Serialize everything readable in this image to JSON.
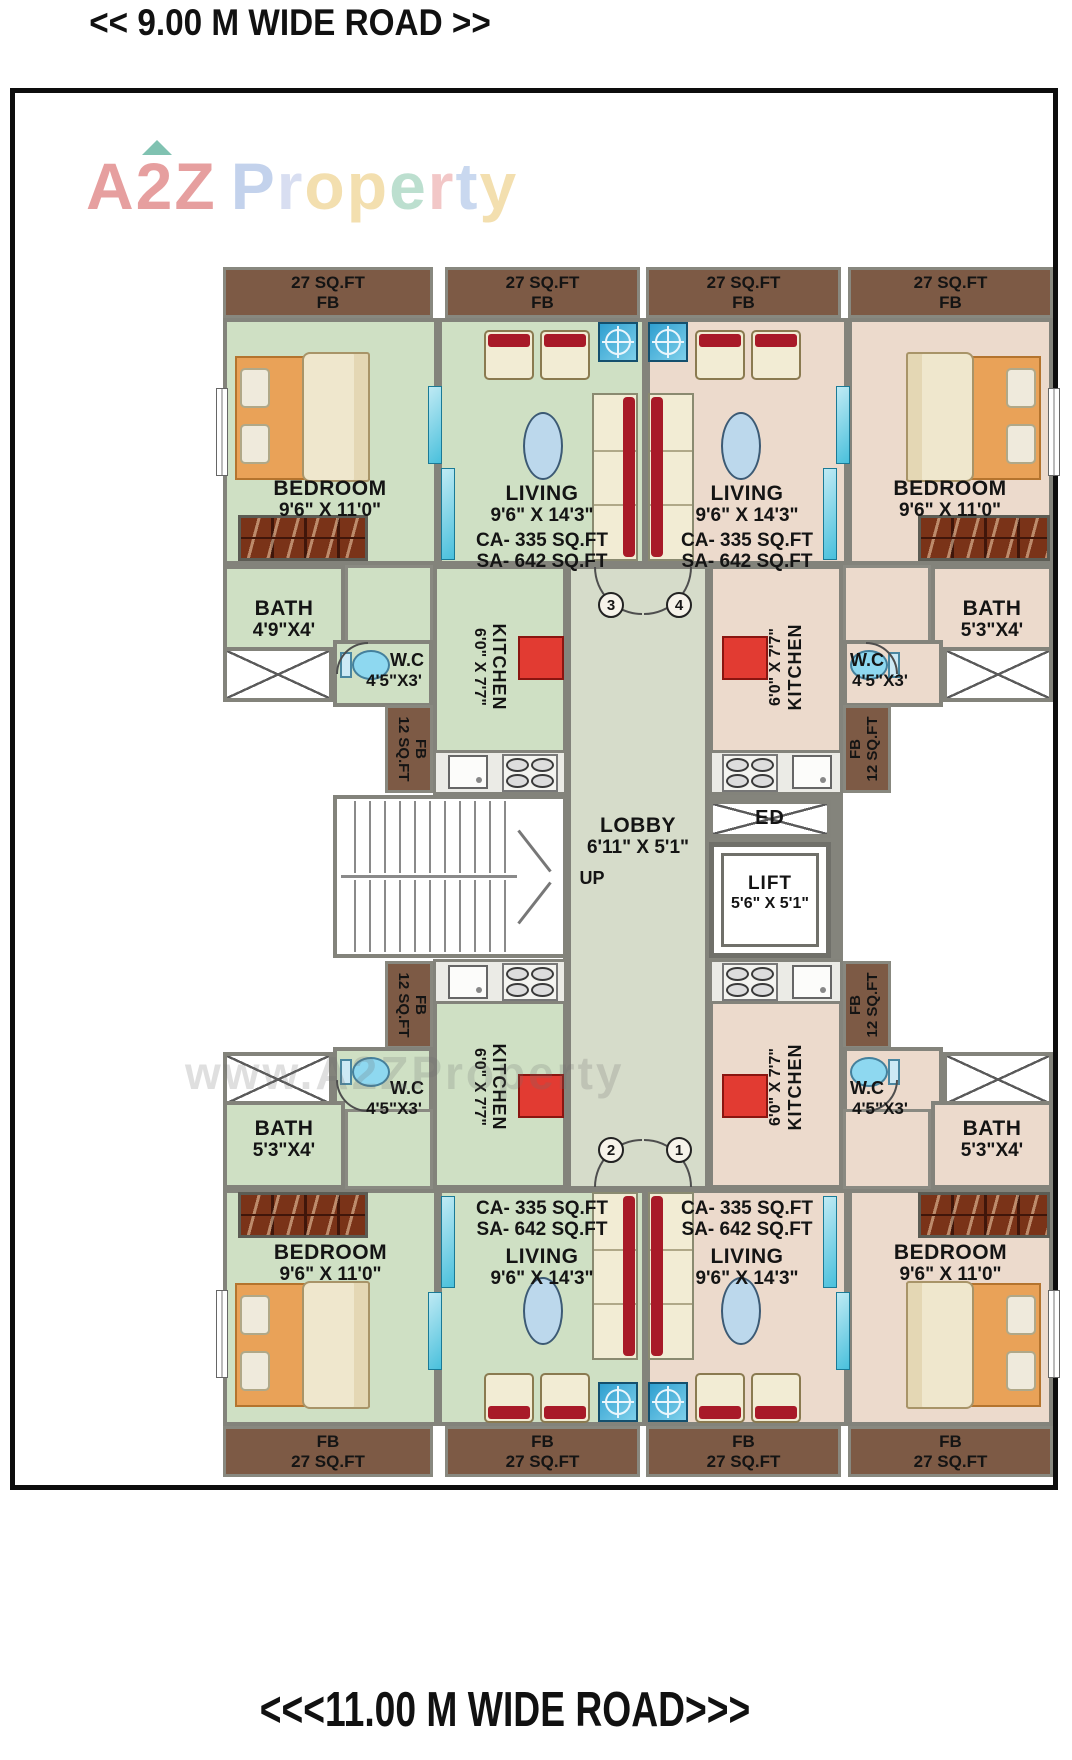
{
  "roads": {
    "top": "<< 9.00 M WIDE ROAD >>",
    "bottom": "<<<11.00 M WIDE ROAD>>>"
  },
  "watermark": {
    "brand": "A2Z",
    "brand_rest": "Property",
    "letter_colors": [
      "#93aede",
      "#b9c4e6",
      "#eac56e",
      "#eac56e",
      "#86c6a8",
      "#e99a9a",
      "#9db9e2",
      "#eac56e"
    ],
    "www": "www.A2ZProperty"
  },
  "colors": {
    "floor_left_wing": "#cfe0c4",
    "floor_right_wing": "#ecdacc",
    "lobby_floor": "#d6dcca",
    "flower_bed_brown": "#7d5a45",
    "wall_gray": "#83837b",
    "kitchen_platform_red": "#e23b32",
    "sofa_red": "#a81a28",
    "fixture_blue": "#8ed8f0",
    "fan_blue": "#2f9fd0"
  },
  "labels": {
    "fb27": {
      "area": "27 SQ.FT",
      "fb": "FB"
    },
    "fb12": {
      "area": "12 SQ.FT",
      "fb": "FB"
    },
    "bedroom": {
      "name": "BEDROOM",
      "dim": "9'6\" X 11'0\""
    },
    "living": {
      "name": "LIVING",
      "dim": "9'6\" X 14'3\"",
      "carpet_area": "CA- 335 SQ.FT",
      "saleable_area": "SA- 642 SQ.FT"
    },
    "bath_a": {
      "name": "BATH",
      "dim": "4'9\"X4'"
    },
    "bath_b": {
      "name": "BATH",
      "dim": "5'3\"X4'"
    },
    "wc": {
      "name": "W.C",
      "dim": "4'5\"X3'"
    },
    "kitchen": {
      "name": "KITCHEN",
      "dim": "6'0\" X 7'7\""
    },
    "lobby": {
      "name": "LOBBY",
      "dim": "6'11\" X 5'1\""
    },
    "lift": {
      "name": "LIFT",
      "dim": "5'6\" X 5'1\""
    },
    "stairs_up": "UP",
    "electrical_duct": "ED",
    "units": [
      "1",
      "2",
      "3",
      "4"
    ]
  }
}
